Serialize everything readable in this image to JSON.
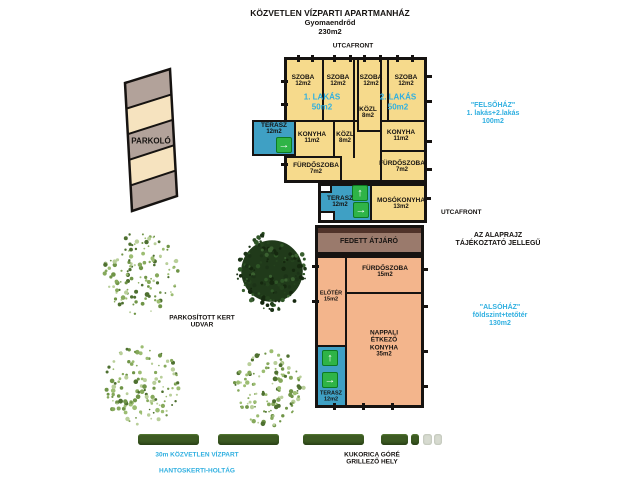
{
  "title": {
    "name": "KÖZVETLEN VÍZPARTI APARTMANHÁZ",
    "city": "Gyomaendrőd",
    "total_area": "230m2"
  },
  "street": {
    "top": "UTCAFRONT",
    "right": "UTCAFRONT"
  },
  "annotations": {
    "felsohaz": "\"FELSŐHÁZ\"\n1. lakás+2.lakás\n100m2",
    "alsohaz": "\"ALSÓHÁZ\"\nföldszint+tetőtér\n130m2",
    "disclaimer": "AZ ALAPRAJZ\nTÁJÉKOZTATÓ JELLEGŰ",
    "garden": "PARKOSÍTOTT KERT\nUDVAR",
    "parking": "PARKOLÓ",
    "waterfront": "30m KÖZVETLEN VÍZPART",
    "backwater": "HANTOSKERTI-HOLTÁG",
    "corncrib": "KUKORICA GÓRÉ\nGRILLEZŐ HELY"
  },
  "upper_house": {
    "apartment1": {
      "name": "1. LAKÁS",
      "area": "50m2"
    },
    "apartment2": {
      "name": "2. LAKÁS",
      "area": "50m2"
    },
    "rooms": [
      {
        "name": "SZOBA",
        "area": "12m2"
      },
      {
        "name": "SZOBA",
        "area": "12m2"
      },
      {
        "name": "SZOBA",
        "area": "12m2"
      },
      {
        "name": "SZOBA",
        "area": "12m2"
      },
      {
        "name": "KÖZL",
        "area": "8m2"
      },
      {
        "name": "KONYHA",
        "area": "11m2"
      },
      {
        "name": "KÖZL",
        "area": "8m2"
      },
      {
        "name": "KONYHA",
        "area": "11m2"
      },
      {
        "name": "FÜRDŐSZOBA",
        "area": "7m2"
      },
      {
        "name": "FÜRDŐSZOBA",
        "area": "7m2"
      },
      {
        "name": "TERASZ",
        "area": "12m2"
      },
      {
        "name": "TERASZ",
        "area": "12m2"
      },
      {
        "name": "MOSÓKONYHA",
        "area": "13m2"
      }
    ]
  },
  "lower_house": {
    "passage": "FEDETT ÁTJÁRÓ",
    "rooms": [
      {
        "name": "FÜRDŐSZOBA",
        "area": "15m2"
      },
      {
        "name": "ELŐTÉR",
        "area": "15m2"
      },
      {
        "name": "NAPPALI\nÉTKEZŐ\nKONYHA",
        "area": "35m2"
      },
      {
        "name": "TERASZ",
        "area": "12m2"
      }
    ]
  },
  "icons": {
    "arrow_up": "↑",
    "arrow_right": "→"
  },
  "colors": {
    "room_yellow": "#f6da8c",
    "terrace_teal": "#3fa0c4",
    "arrow_green": "#2fb447",
    "passage_brown": "#9a7a6c",
    "passage_dark": "#50332a",
    "lower_salmon": "#f3b58c",
    "accent_cyan": "#2fafe0",
    "hedge_green": "#3d5a23",
    "parking_gray": "#b2a29a",
    "parking_cream": "#f6e3bf",
    "wall_black": "#161311"
  }
}
